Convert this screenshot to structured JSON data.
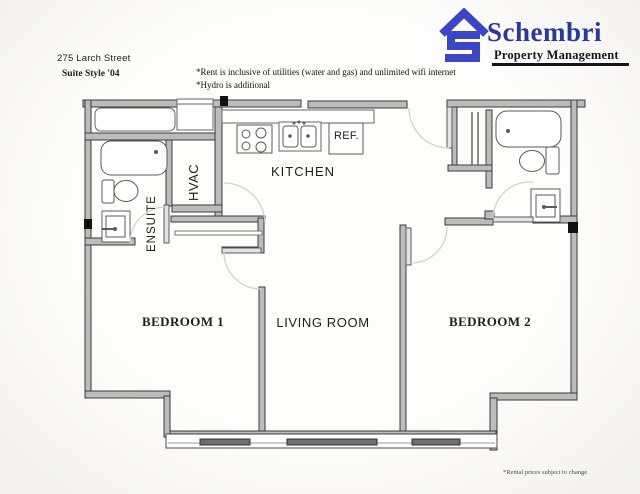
{
  "header": {
    "address": "275 Larch Street",
    "suite_style": "Suite Style '04",
    "note1": "*Rent is inclusive of utilities (water and gas) and unlimited wifi internet",
    "note2": "*Hydro is additional"
  },
  "logo": {
    "name": "Schembri",
    "tagline": "Property Management",
    "brand_color": "#2c3897",
    "icon": "house-s-icon",
    "icon_color": "#3a46c4"
  },
  "rooms": {
    "kitchen": "KITCHEN",
    "fridge": "REF.",
    "ensuite": "ENSUITE",
    "hvac": "HVAC",
    "bedroom1": "BEDROOM 1",
    "living": "LIVING ROOM",
    "bedroom2": "BEDROOM 2"
  },
  "footer": {
    "disclaimer": "*Rental prices subject to change"
  },
  "colors": {
    "wall_fill": "#bcbcbc",
    "wall_line": "#3a3a3a",
    "fixture_line": "#5a5a5a",
    "door_arc": "#d2d2d2",
    "window_bar": "#6e6e6e",
    "panel_black": "#121212"
  }
}
